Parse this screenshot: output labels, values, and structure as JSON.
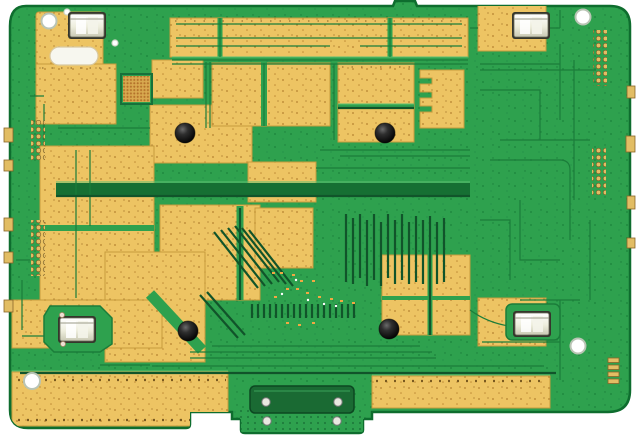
{
  "caption": "Photograph of a bare green printed circuit board with large exposed gold copper-pour regions, four silver shield-clip connectors near the corners, four white mounting holes, four black rubber grommets, a BGA pad array, gold via arrays along the edges, and a bottom edge-connector tab.",
  "scene": {
    "type": "photo",
    "subject": "printed circuit board (PCB), top view",
    "background": "white"
  },
  "colors": {
    "board_green": "#2ea14e",
    "trace_dark_green": "#1b7d3a",
    "dense_trace_green": "#11542a",
    "copper_gold": "#edc463",
    "gold_edge": "#c79b3d",
    "metal_silver": "#e9e9dc",
    "component_black": "#141414",
    "hole_white": "#ffffff",
    "background_white": "#ffffff"
  },
  "features": {
    "mounting_holes": 4,
    "shield_clip_connectors": 4,
    "rubber_grommets": 4,
    "bga_pad_arrays": 1,
    "via_arrays": 4,
    "bottom_edge_connector_tabs": 1,
    "copper_pour_regions": 16
  }
}
